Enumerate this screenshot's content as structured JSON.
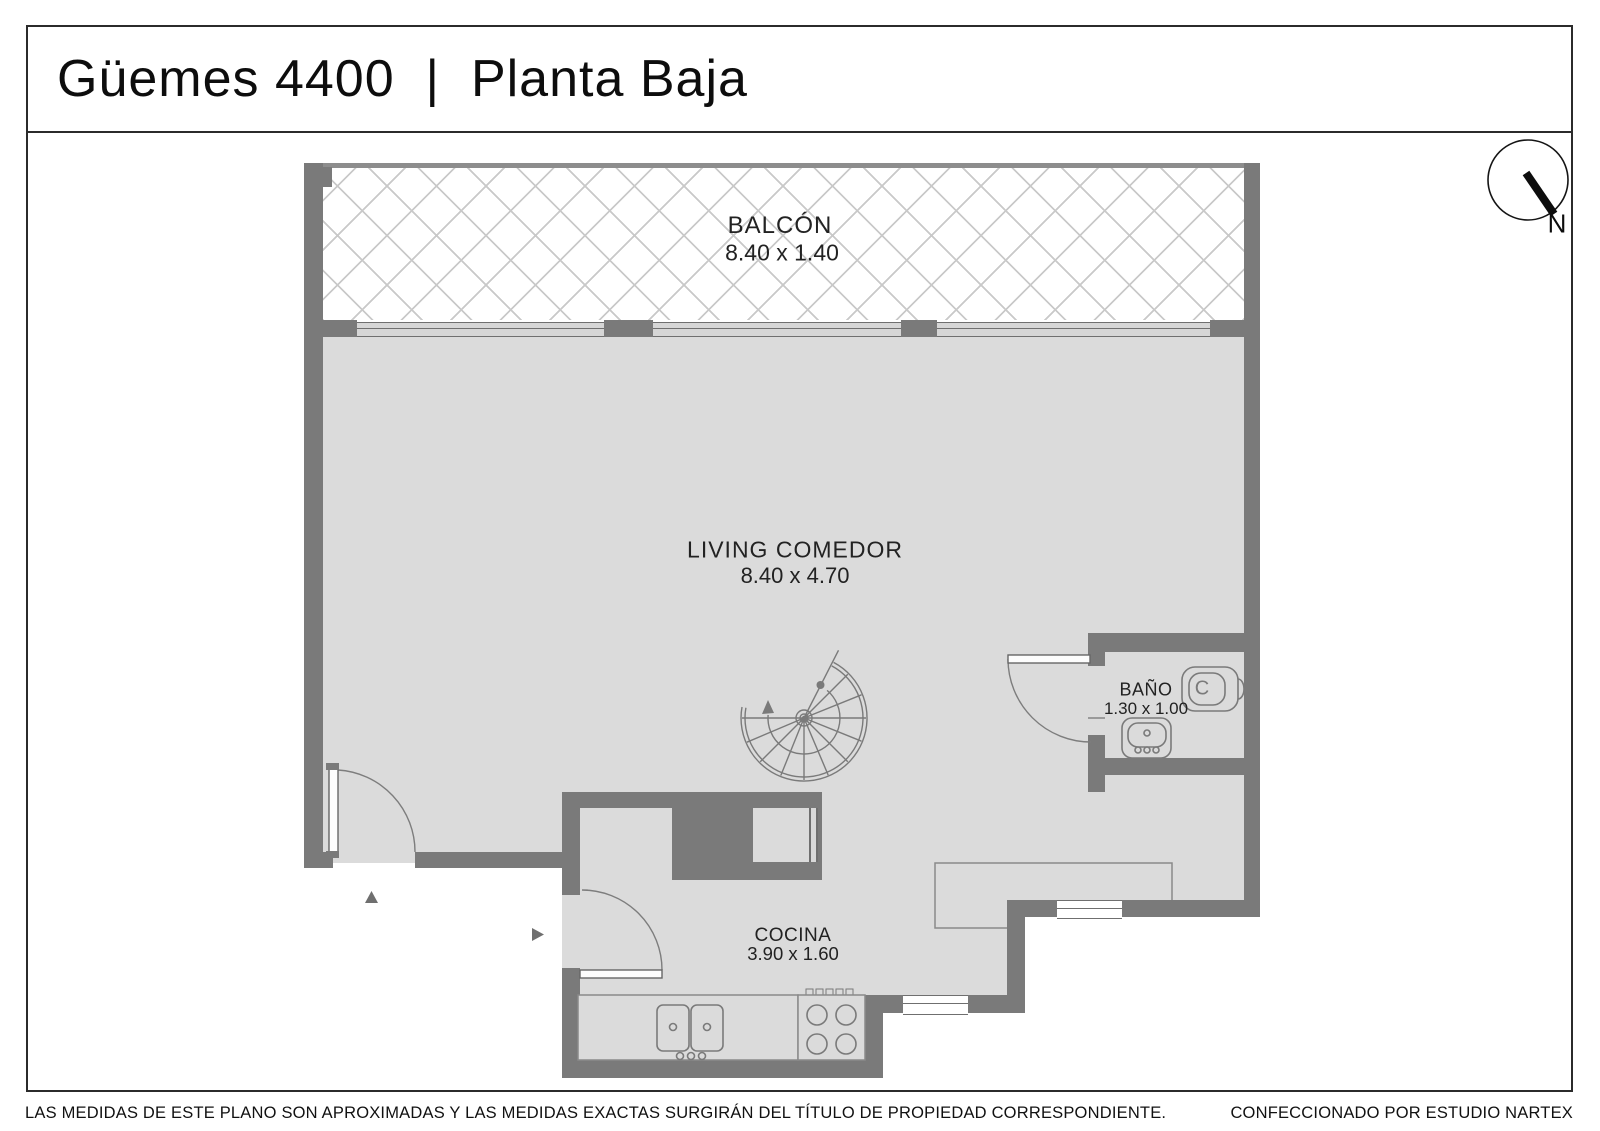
{
  "header": {
    "title": "Güemes 4400  |  Planta Baja"
  },
  "compass": {
    "north_label": "N"
  },
  "rooms": {
    "balcony": {
      "name": "BALCÓN",
      "dims": "8.40 x 1.40"
    },
    "living": {
      "name": "LIVING COMEDOR",
      "dims": "8.40 x 4.70"
    },
    "bathroom": {
      "name": "BAÑO",
      "dims": "1.30 x 1.00",
      "toilet_label": "C"
    },
    "kitchen": {
      "name": "COCINA",
      "dims": "3.90 x 1.60"
    }
  },
  "footer": {
    "disclaimer": "LAS MEDIDAS  DE ESTE PLANO SON APROXIMADAS Y LAS MEDIDAS EXACTAS SURGIRÁN DEL TÍTULO DE PROPIEDAD CORRESPONDIENTE.",
    "credit": "CONFECCIONADO POR ESTUDIO NARTEX"
  },
  "colors": {
    "wall": "#7a7a7a",
    "floor": "#dbdbdb",
    "line": "#6f6f6f"
  }
}
